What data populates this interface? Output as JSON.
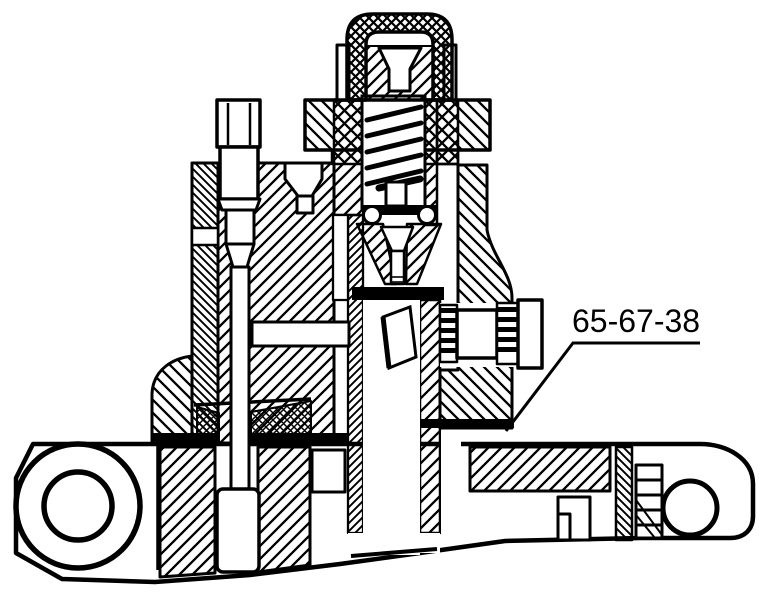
{
  "figure": {
    "kind": "engineering-cross-section",
    "background_color": "#ffffff",
    "line_color": "#000000"
  },
  "callout": {
    "label": "65-67-38"
  }
}
